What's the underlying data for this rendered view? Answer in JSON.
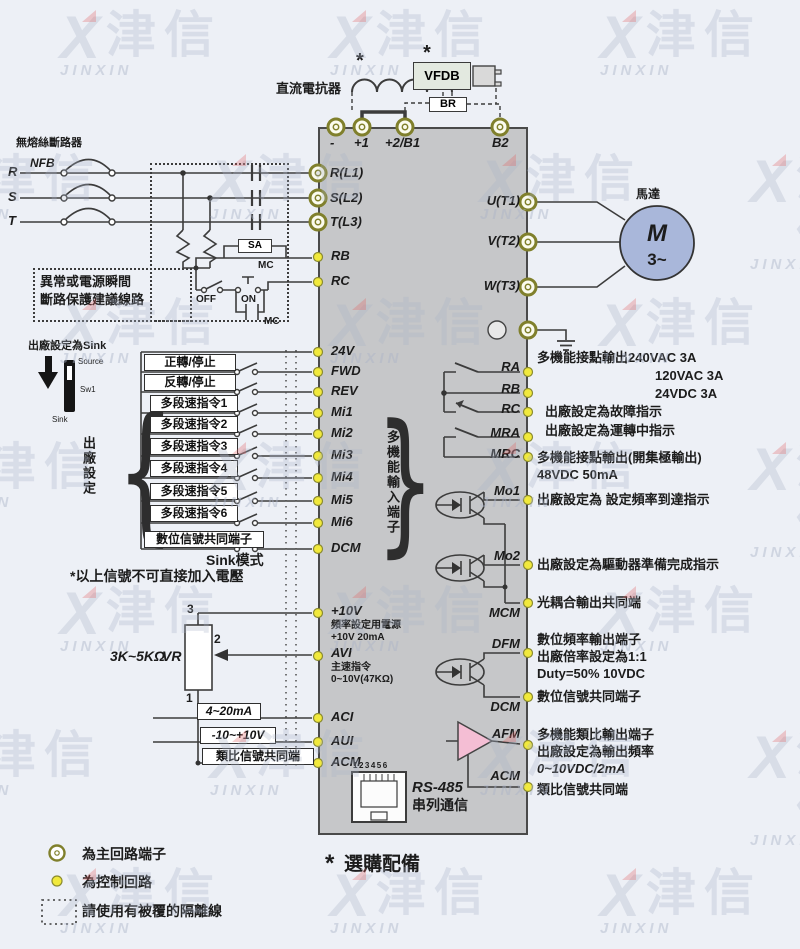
{
  "branding": {
    "cn": "津信",
    "en": "JINXIN"
  },
  "top": {
    "reactor_star": "*",
    "reactor_label": "直流電抗器",
    "vfdb_star": "*",
    "vfdb": "VFDB",
    "br": "BR",
    "terminals": {
      "minus": "-",
      "p1": "+1",
      "p2b1": "+2/B1",
      "b2": "B2"
    }
  },
  "power": {
    "breaker": "無熔絲斷路器",
    "nfb": "NFB",
    "r": "R",
    "s": "S",
    "t": "T",
    "sa": "SA",
    "mc_coil": "MC",
    "off": "OFF",
    "on": "ON",
    "mc_contact": "MC",
    "note1": "異常或電源瞬間",
    "note2": "斷路保護建議線路"
  },
  "left_terminals": {
    "rl1": "R(L1)",
    "sl2": "S(L2)",
    "tl3": "T(L3)",
    "rb": "RB",
    "rc": "RC",
    "v24": "24V",
    "fwd": "FWD",
    "rev": "REV",
    "mi1": "Mi1",
    "mi2": "Mi2",
    "mi3": "Mi3",
    "mi4": "Mi4",
    "mi5": "Mi5",
    "mi6": "Mi6",
    "dcm": "DCM",
    "p10v": "+10V",
    "avi": "AVI",
    "aci": "ACI",
    "aui": "AUI",
    "acm": "ACM"
  },
  "digital": {
    "sink_note": "出廠設定為Sink",
    "sw_source": "Source",
    "sw_sw1": "Sw1",
    "sw_sink": "Sink",
    "factory": "出廠設定",
    "rows": [
      "正轉/停止",
      "反轉/停止",
      "多段速指令1",
      "多段速指令2",
      "多段速指令3",
      "多段速指令4",
      "多段速指令5",
      "多段速指令6",
      "數位信號共同端子"
    ],
    "sink_mode": "Sink模式",
    "warning": "*以上信號不可直接加入電壓",
    "group": "多機能輸入端子"
  },
  "analog": {
    "pot": "3K~5KΩ",
    "vr": "VR",
    "pin3": "3",
    "pin2": "2",
    "pin1": "1",
    "p10v_note1": "頻率設定用電源",
    "p10v_note2": "+10V 20mA",
    "avi_note1": "主速指令",
    "avi_note2": "0~10V(47KΩ)",
    "aci": "4~20mA",
    "aui": "-10~+10V",
    "acm": "類比信號共同端"
  },
  "motor": {
    "label": "馬達",
    "m": "M",
    "phase": "3~"
  },
  "right_terminals": {
    "ut1": "U(T1)",
    "vt2": "V(T2)",
    "wt3": "W(T3)",
    "ra": "RA",
    "rb": "RB",
    "rc": "RC",
    "mra": "MRA",
    "mrc": "MRC",
    "mo1": "Mo1",
    "mo2": "Mo2",
    "mcm": "MCM",
    "dfm": "DFM",
    "dcm": "DCM",
    "afm": "AFM",
    "acm": "ACM"
  },
  "right_notes": {
    "relay1": "多機能接點輸出240VAC 3A",
    "relay2": "120VAC 3A",
    "relay3": "24VDC 3A",
    "rc": "出廠設定為故障指示",
    "mra": "出廠設定為運轉中指示",
    "oc1": "多機能接點輸出(開集極輸出)",
    "oc2": "48VDC 50mA",
    "mo1": "出廠設定為 設定頻率到達指示",
    "mo2": "出廠設定為驅動器準備完成指示",
    "mcm": "光耦合輸出共同端",
    "dfm1": "數位頻率輸出端子",
    "dfm2": "出廠倍率設定為1:1",
    "dfm3": "Duty=50% 10VDC",
    "dcm": "數位信號共同端子",
    "afm1": "多機能類比輸出端子",
    "afm2": "出廠設定為輸出頻率",
    "afm3": "0~10VDC/2mA",
    "acm": "類比信號共同端"
  },
  "rs485": {
    "pins": "123456",
    "label": "RS-485",
    "sub": "串列通信"
  },
  "legend": {
    "main": "為主回路端子",
    "control": "為控制回路",
    "shield": "請使用有被覆的隔離線",
    "optional_star": "*",
    "optional": "選購配備"
  }
}
